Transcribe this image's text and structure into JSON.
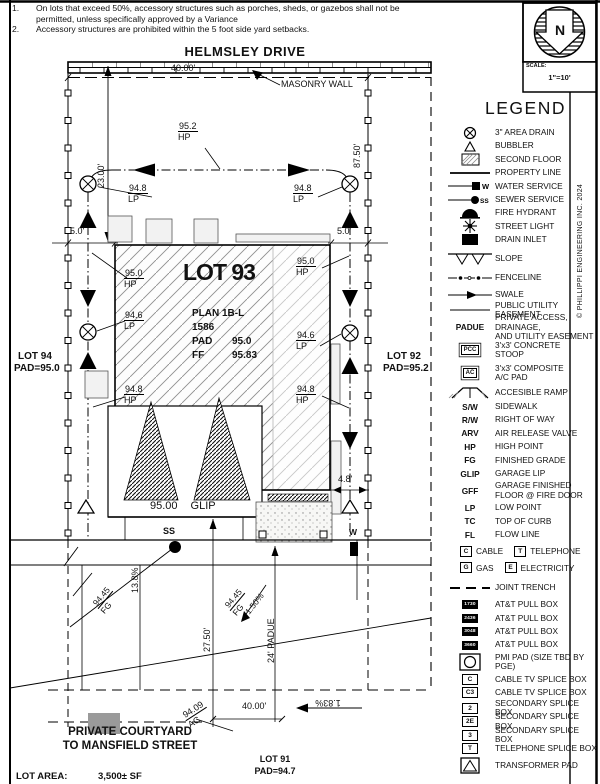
{
  "notes": {
    "items": [
      {
        "num": "1.",
        "text": "On lots that exceed 50%, accessory structures such as porches, sheds, or gazebos shall not be permitted, unless specifically approved by a Variance"
      },
      {
        "num": "2.",
        "text": "Accessory structures are prohibited within the 5 foot side yard setbacks."
      }
    ]
  },
  "street": {
    "name": "HELMSLEY DRIVE"
  },
  "north": {
    "letter": "N",
    "scale_label": "SCALE:",
    "scale_value": "1\"=10'"
  },
  "copyright": "© PHILLIPPI ENGINEERING INC. 2024",
  "legend": {
    "title": "LEGEND",
    "items": [
      {
        "sym": "area-drain",
        "label": "3\" AREA DRAIN"
      },
      {
        "sym": "bubbler",
        "label": "BUBBLER"
      },
      {
        "sym": "second-floor",
        "label": "SECOND FLOOR"
      },
      {
        "sym": "property-line",
        "label": "PROPERTY LINE"
      },
      {
        "sym": "water-service",
        "tag": "W",
        "label": "WATER SERVICE"
      },
      {
        "sym": "sewer-service",
        "tag": "SS",
        "label": "SEWER SERVICE"
      },
      {
        "sym": "fire-hydrant",
        "label": "FIRE HYDRANT"
      },
      {
        "sym": "street-light",
        "label": "STREET LIGHT"
      },
      {
        "sym": "drain-inlet",
        "label": "DRAIN INLET"
      },
      {
        "sym": "slope",
        "label": "SLOPE"
      },
      {
        "sym": "fenceline",
        "label": "FENCELINE"
      },
      {
        "sym": "swale",
        "label": "SWALE"
      },
      {
        "sym": "pue-line",
        "label": "PUBLIC UTILITY EASEMENT"
      },
      {
        "sym": "abbr",
        "abbr": "PADUE",
        "label": "PRIVATE ACCESS, DRAINAGE,",
        "label2": "AND UTILITY EASEMENT"
      },
      {
        "sym": "box-label",
        "box": "PCC",
        "label": "3'x3' CONCRETE",
        "label2": "STOOP"
      },
      {
        "sym": "box-label",
        "box": "AC",
        "label": "3'x3' COMPOSITE",
        "label2": "A/C PAD"
      },
      {
        "sym": "ramp",
        "label": "ACCESIBLE RAMP"
      },
      {
        "sym": "abbr",
        "abbr": "S/W",
        "label": "SIDEWALK"
      },
      {
        "sym": "abbr",
        "abbr": "R/W",
        "label": "RIGHT OF WAY"
      },
      {
        "sym": "abbr",
        "abbr": "ARV",
        "label": "AIR RELEASE VALVE"
      },
      {
        "sym": "abbr",
        "abbr": "HP",
        "label": "HIGH POINT"
      },
      {
        "sym": "abbr",
        "abbr": "FG",
        "label": "FINISHED GRADE"
      },
      {
        "sym": "abbr",
        "abbr": "GLIP",
        "label": "GARAGE LIP"
      },
      {
        "sym": "abbr",
        "abbr": "GFF",
        "label": "GARAGE FINISHED",
        "label2": "FLOOR @ FIRE DOOR"
      },
      {
        "sym": "abbr",
        "abbr": "LP",
        "label": "LOW POINT"
      },
      {
        "sym": "abbr",
        "abbr": "TC",
        "label": "TOP OF CURB"
      },
      {
        "sym": "abbr",
        "abbr": "FL",
        "label": "FLOW LINE"
      },
      {
        "sym": "pair",
        "a_box": "C",
        "a_label": "CABLE",
        "b_box": "T",
        "b_label": "TELEPHONE"
      },
      {
        "sym": "pair",
        "a_box": "G",
        "a_label": "GAS",
        "b_box": "E",
        "b_label": "ELECTRICITY"
      },
      {
        "sym": "joint-trench",
        "label": "JOINT TRENCH"
      },
      {
        "sym": "black-box",
        "box": "1730",
        "label": "AT&T PULL BOX"
      },
      {
        "sym": "black-box",
        "box": "2436",
        "label": "AT&T PULL BOX"
      },
      {
        "sym": "black-box",
        "box": "3048",
        "label": "AT&T PULL BOX"
      },
      {
        "sym": "black-box",
        "box": "3660",
        "label": "AT&T PULL BOX"
      },
      {
        "sym": "pmi",
        "label": "PMI PAD (SIZE TBD BY PGE)"
      },
      {
        "sym": "wbox",
        "box": "C",
        "label": "CABLE TV SPLICE BOX"
      },
      {
        "sym": "wbox",
        "box": "C3",
        "label": "CABLE TV SPLICE BOX"
      },
      {
        "sym": "wbox",
        "box": "2",
        "label": "SECONDARY SPLICE BOX"
      },
      {
        "sym": "wbox",
        "box": "2E",
        "label": "SECONDARY SPLICE BOX"
      },
      {
        "sym": "wbox",
        "box": "3",
        "label": "SECONDARY SPLICE BOX"
      },
      {
        "sym": "wbox",
        "box": "T",
        "label": "TELEPHONE SPLICE BOX"
      },
      {
        "sym": "transformer",
        "label": "TRANSFORMER PAD"
      }
    ]
  },
  "plan": {
    "dims": {
      "top40": "40.00'",
      "left23": "23.00'",
      "right8750": "87.50'",
      "left5": "5.0'",
      "right5": "5.0'",
      "d48": "4.8'",
      "d2750": "27.50'",
      "padue24": "24' PADUE",
      "bottom40": "40.00'"
    },
    "labels": {
      "masonry": "MASONRY WALL",
      "ss": "SS",
      "w": "W",
      "pct138": "13.8%",
      "pct150": "1.50%",
      "pct183": "1.83%",
      "glip_v": "95.00",
      "glip_a": "GLIP",
      "courtyard1": "PRIVATE COURTYARD",
      "courtyard2": "TO MANSFIELD STREET",
      "lot_area_label": "LOT AREA:",
      "lot_area_value": "3,500± SF"
    },
    "house": {
      "lot": "LOT 93",
      "plan": "PLAN 1B-L",
      "plan_num": "1586",
      "pad_label": "PAD",
      "pad_value": "95.0",
      "ff_label": "FF",
      "ff_value": "95.83"
    },
    "lots": {
      "lot94": {
        "name": "LOT 94",
        "pad": "PAD=95.0"
      },
      "lot92": {
        "name": "LOT 92",
        "pad": "PAD=95.2"
      },
      "lot91": {
        "name": "LOT 91",
        "pad": "PAD=94.7"
      }
    },
    "spots": {
      "hp952": {
        "v": "95.2",
        "a": "HP"
      },
      "lp948l": {
        "v": "94.8",
        "a": "LP"
      },
      "lp948r": {
        "v": "94.8",
        "a": "LP"
      },
      "hp950l": {
        "v": "95.0",
        "a": "HP"
      },
      "hp950r": {
        "v": "95.0",
        "a": "HP"
      },
      "lp946l": {
        "v": "94.6",
        "a": "LP"
      },
      "lp946r": {
        "v": "94.6",
        "a": "LP"
      },
      "hp948l": {
        "v": "94.8",
        "a": "HP"
      },
      "hp948r": {
        "v": "94.8",
        "a": "HP"
      },
      "fg1": {
        "v": "94.45",
        "a": "FG"
      },
      "fg2": {
        "v": "94.45",
        "a": "FG"
      },
      "ac9409": {
        "v": "94.09",
        "a": "AC"
      }
    }
  }
}
